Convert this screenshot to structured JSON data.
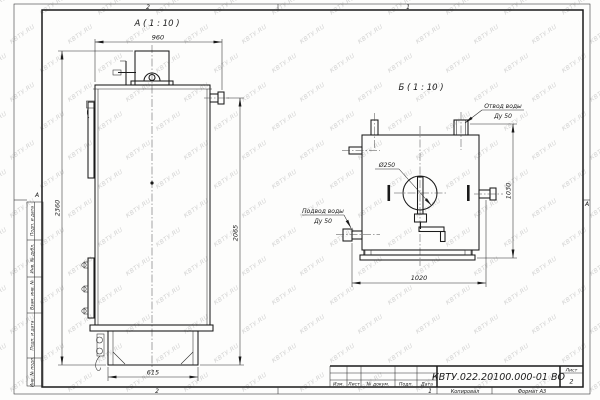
{
  "watermark": {
    "text": "КВТУ.RU"
  },
  "zones": {
    "top_left": "2",
    "top_right": "1",
    "bottom_left": "2",
    "bottom_right": "1",
    "left_letter": "А",
    "right_letter": "А"
  },
  "margin_columns": {
    "items": [
      {
        "label": "Подп. и дата"
      },
      {
        "label": "Инв. № дубл."
      },
      {
        "label": "Взам. инв. №"
      },
      {
        "label": "Подп. и дата"
      },
      {
        "label": "Инв. № подл."
      }
    ]
  },
  "views": {
    "a": {
      "title": "А ( 1 : 10 )",
      "dims": {
        "width_top": "960",
        "height_overall": "2360",
        "height_body": "2065",
        "width_base": "615"
      }
    },
    "b": {
      "title": "Б ( 1 : 10 )",
      "dims": {
        "width_base": "1020",
        "height": "1030",
        "flue_diameter": "Ø250"
      },
      "labels": {
        "outlet_line1": "Отвод воды",
        "outlet_line2": "Ду 50",
        "inlet_line1": "Подвод воды",
        "inlet_line2": "Ду 50"
      }
    }
  },
  "title_block": {
    "doc_number": "КВТУ.022.20100.000-01 ВО",
    "sheet_label": "Лист",
    "sheet_number": "2",
    "columns": [
      "Изм.",
      "Лист",
      "№ докум.",
      "Подп.",
      "Дата"
    ],
    "copied_label": "Копировал",
    "format_label": "Формат А3"
  }
}
